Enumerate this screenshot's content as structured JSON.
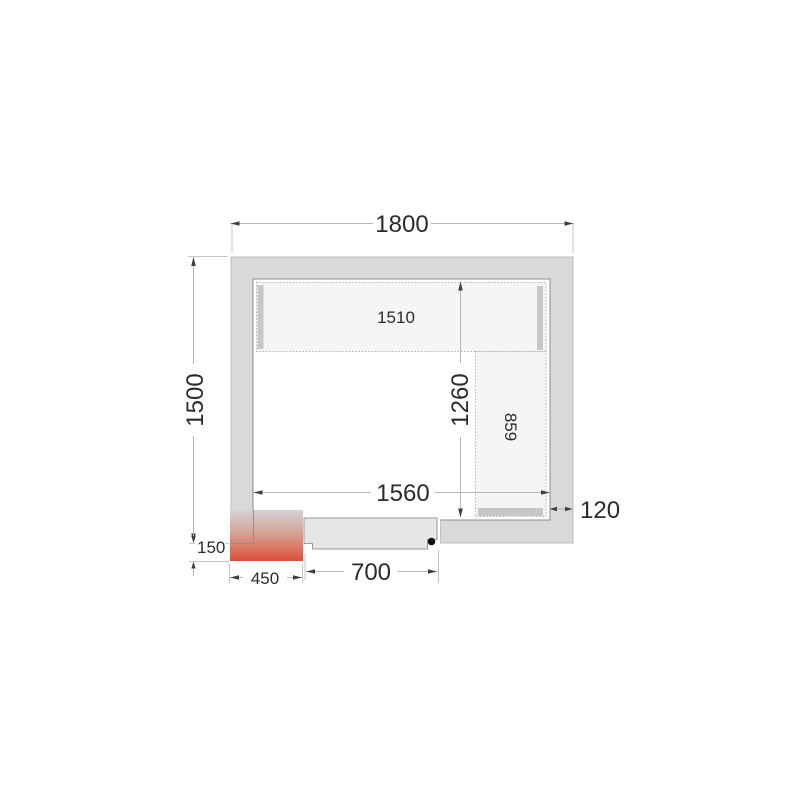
{
  "drawing": {
    "type": "cold-room-floor-plan",
    "labels": {
      "outer_width": "1800",
      "outer_height": "1500",
      "inner_width": "1560",
      "inner_height": "1260",
      "wall_thickness": "120",
      "top_shelf_length": "1510",
      "side_shelf_length": "859",
      "heater_width": "450",
      "heater_depth": "150",
      "door_width": "700"
    },
    "colors": {
      "wall_fill": "#d9d9d9",
      "wall_stroke": "#bdbdbd",
      "inner_fill": "#ffffff",
      "inner_stroke": "#8f8f8f",
      "shelf_fill": "#f5f5f5",
      "support_fill": "#c7c7c7",
      "door_fill": "#e6e6e6",
      "door_stroke": "#9a9a9a",
      "heater_top": "#d3d3d3",
      "heater_mid1": "#d4a89e",
      "heater_mid2": "#dc7663",
      "heater_bottom": "#d94f3c",
      "handle_dot": "#111111"
    }
  }
}
